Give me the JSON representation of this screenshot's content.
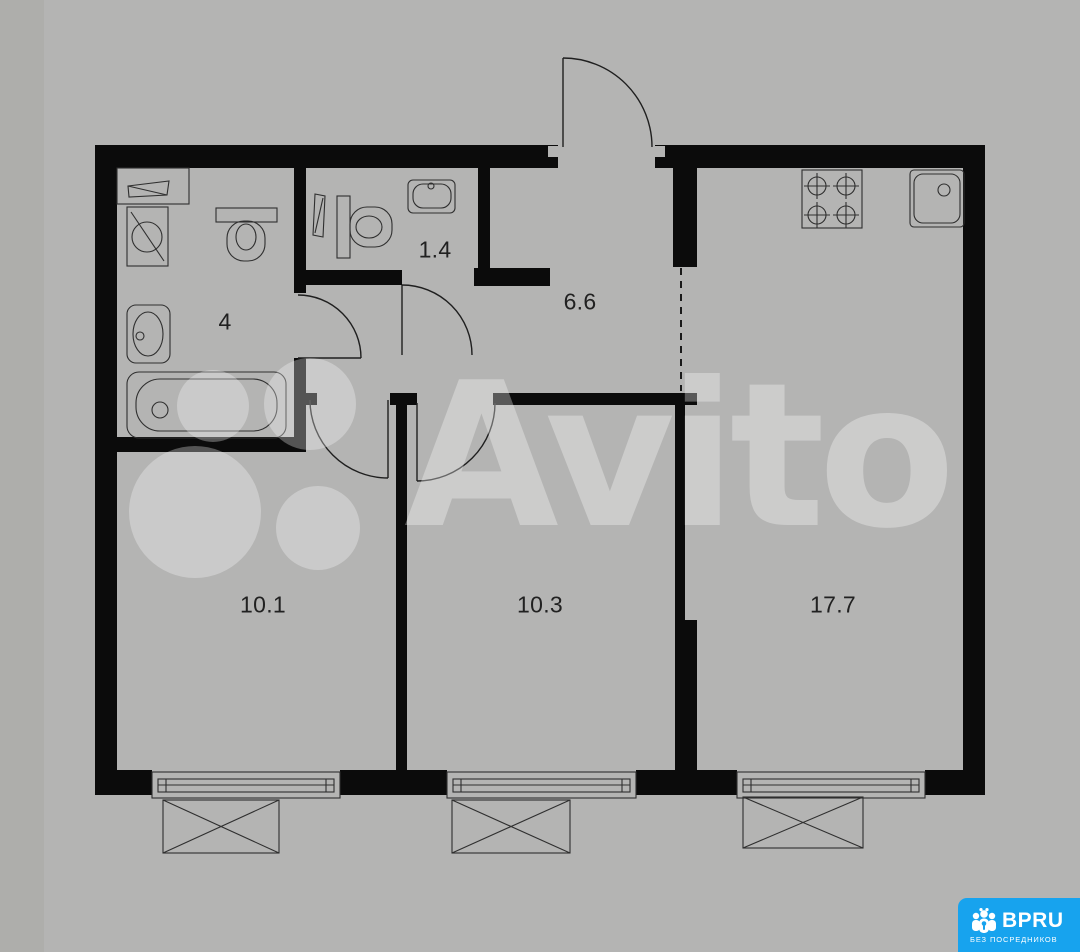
{
  "page": {
    "type": "apartment-floor-plan",
    "background_color": "#b4b4b3",
    "wall_color": "#0b0b0b",
    "line_color": "#2f2f2f"
  },
  "floor_plan": {
    "rooms": [
      {
        "id": "bathroom",
        "area_label": "4"
      },
      {
        "id": "wc",
        "area_label": "1.4"
      },
      {
        "id": "hallway",
        "area_label": "6.6"
      },
      {
        "id": "room-left",
        "area_label": "10.1"
      },
      {
        "id": "room-middle",
        "area_label": "10.3"
      },
      {
        "id": "kitchen-living",
        "area_label": "17.7"
      }
    ],
    "fixtures": [
      "shelf",
      "washing-machine",
      "toilet",
      "wash-basin",
      "bathtub",
      "wc-panel",
      "wc-toilet",
      "wc-sink",
      "stove-4-burner",
      "kitchen-sink",
      "window",
      "window",
      "window"
    ]
  },
  "watermark": {
    "text": "Avito",
    "color": "rgba(255,255,255,0.32)"
  },
  "badge": {
    "brand": "BPRU",
    "tagline": "БЕЗ ПОСРЕДНИКОВ",
    "background": "#17a3ee",
    "text_color": "#ffffff"
  }
}
